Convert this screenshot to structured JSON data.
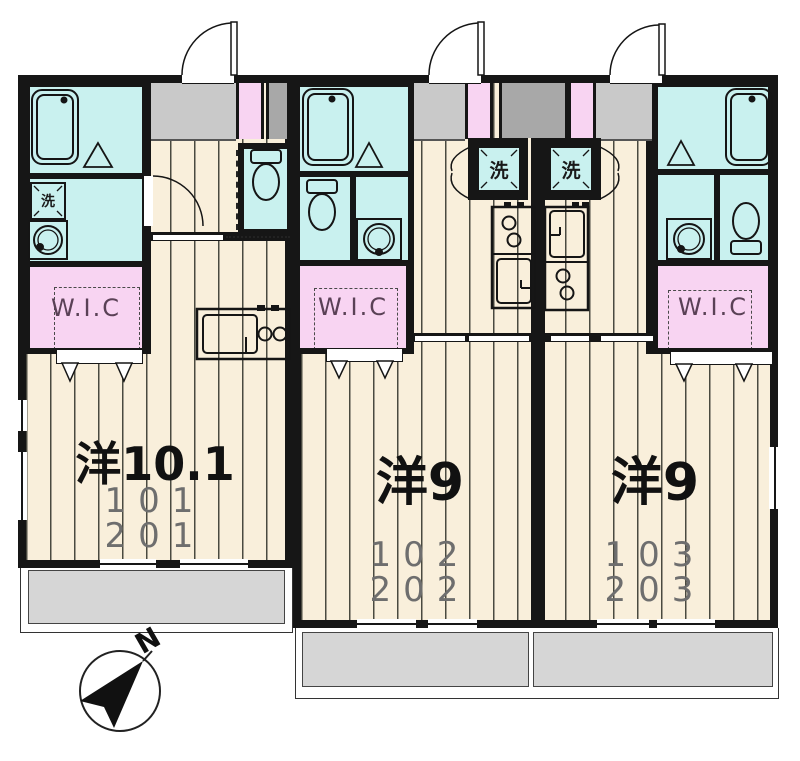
{
  "plan_title": "apartment floor plan",
  "units": [
    {
      "room_label": "洋10.1",
      "numbers": [
        "101",
        "201"
      ],
      "wic_label": "W.I.C",
      "laundry_label": "洗"
    },
    {
      "room_label": "洋9",
      "numbers": [
        "102",
        "202"
      ],
      "wic_label": "W.I.C",
      "laundry_label": "洗"
    },
    {
      "room_label": "洋9",
      "numbers": [
        "103",
        "203"
      ],
      "wic_label": "W.I.C",
      "laundry_label": "洗"
    }
  ],
  "compass": {
    "north_label": "N"
  },
  "colors": {
    "wall": "#161616",
    "floor": "#f9efdb",
    "plank": "#4a4a40",
    "wet": "#c9f1ef",
    "pink": "#f8d4f2",
    "egray": "#c9c9c9",
    "cgray": "#a8a8a8",
    "bgray": "#d6d6d6",
    "numgray": "#6e6e6e",
    "wictext": "#5a4156"
  }
}
